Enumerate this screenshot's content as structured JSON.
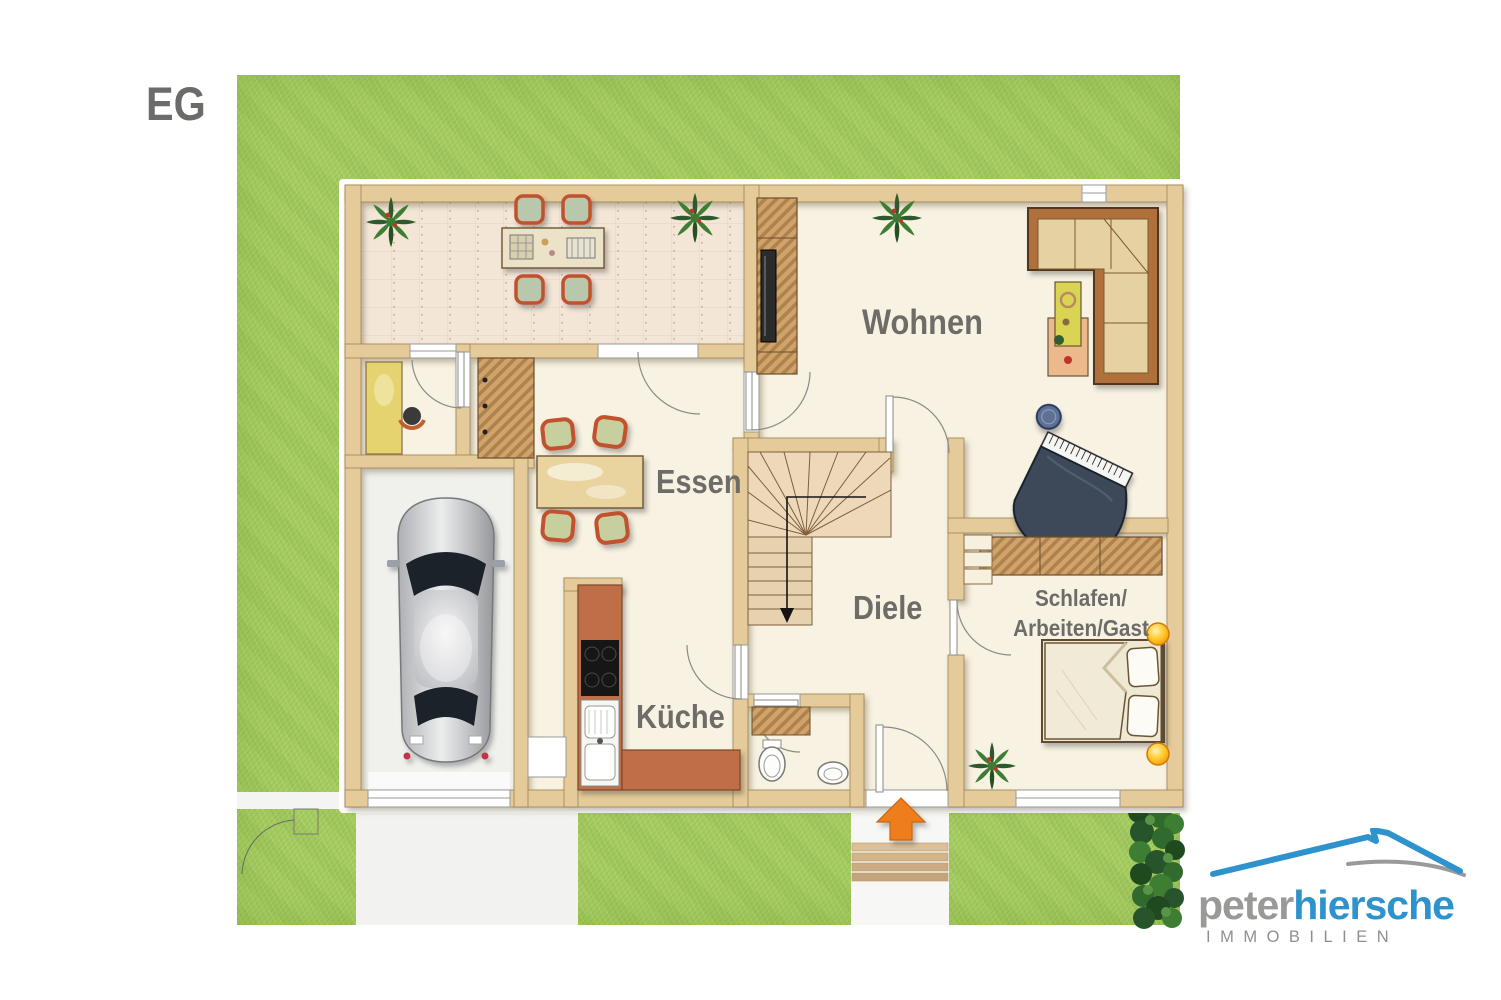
{
  "floor_label": "EG",
  "rooms": {
    "wohnen": "Wohnen",
    "essen": "Essen",
    "diele": "Diele",
    "kueche": "Küche",
    "schlafen_line1": "Schlafen/",
    "schlafen_line2": "Arbeiten/Gast"
  },
  "logo": {
    "name_gray": "peter",
    "name_blue": "hiersche",
    "subtitle": "IMMOBILIEN"
  },
  "colors": {
    "grass": "#a5cc62",
    "wall": "#e5cb9a",
    "floor": "#f8f2e2",
    "terrace_floor": "#f3e6d7",
    "garage_floor": "#f0f0ed",
    "kitchen_counter": "#c06e46",
    "entry_arrow": "#ee7d1d",
    "label_text": "#6e6c68",
    "logo_blue": "#2e93cc",
    "logo_gray": "#9a9998"
  }
}
